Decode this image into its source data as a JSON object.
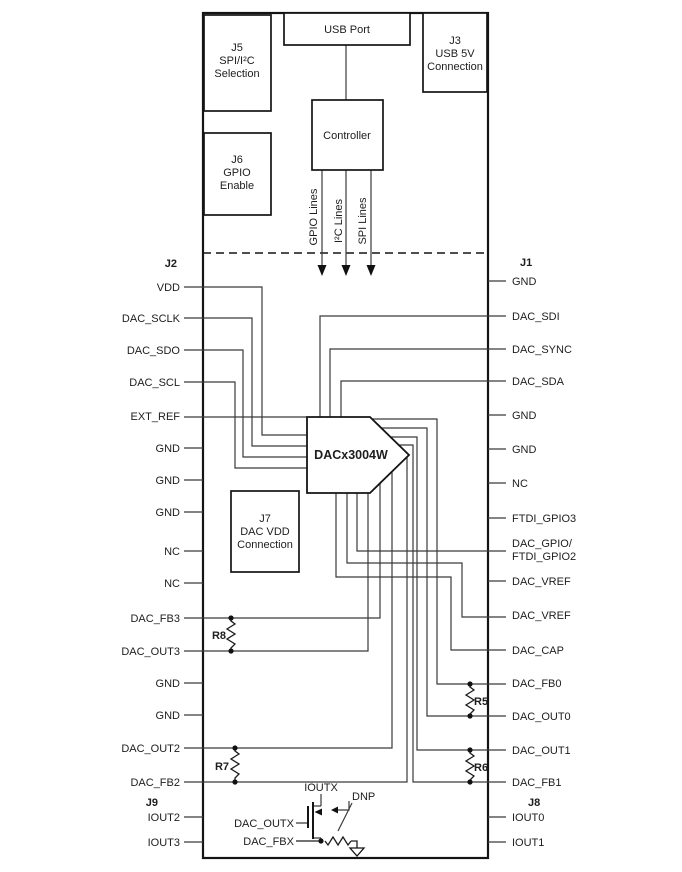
{
  "boxes": {
    "usb_port": {
      "title": "USB Port"
    },
    "j3": {
      "line1": "J3",
      "line2": "USB 5V",
      "line3": "Connection"
    },
    "j5": {
      "line1": "J5",
      "line2": "SPI/I²C",
      "line3": "Selection"
    },
    "j6": {
      "line1": "J6",
      "line2": "GPIO",
      "line3": "Enable"
    },
    "j7": {
      "line1": "J7",
      "line2": "DAC VDD",
      "line3": "Connection"
    },
    "controller": {
      "title": "Controller"
    }
  },
  "buses": {
    "gpio": "GPIO Lines",
    "i2c": "I²C Lines",
    "spi": "SPI Lines"
  },
  "chip": {
    "label": "DACx3004W"
  },
  "headers": {
    "j2": "J2",
    "j1": "J1",
    "j9": "J9",
    "j8": "J8"
  },
  "j2_pins": [
    "VDD",
    "DAC_SCLK",
    "DAC_SDO",
    "DAC_SCL",
    "EXT_REF",
    "GND",
    "GND",
    "GND",
    "NC",
    "NC",
    "DAC_FB3",
    "DAC_OUT3",
    "GND",
    "GND",
    "DAC_OUT2",
    "DAC_FB2"
  ],
  "j9_pins": [
    "IOUT2",
    "IOUT3"
  ],
  "j1_pins": [
    "GND",
    "DAC_SDI",
    "DAC_SYNC",
    "DAC_SDA",
    "GND",
    "GND",
    "NC",
    "FTDI_GPIO3",
    "DAC_GPIO/",
    "FTDI_GPIO2",
    "DAC_VREF",
    "DAC_VREF",
    "DAC_CAP",
    "DAC_FB0",
    "DAC_OUT0",
    "DAC_OUT1",
    "DAC_FB1"
  ],
  "j8_pins": [
    "IOUT0",
    "IOUT1"
  ],
  "resistors": {
    "r5": "R5",
    "r6": "R6",
    "r7": "R7",
    "r8": "R8"
  },
  "output_stage": {
    "ioutx": "IOUTX",
    "dac_outx": "DAC_OUTX",
    "dac_fbx": "DAC_FBX",
    "dnp": "DNP"
  },
  "colors": {
    "line": "#3a3a3a",
    "border": "#141414",
    "text": "#1d1d1d",
    "background": "#ffffff"
  }
}
